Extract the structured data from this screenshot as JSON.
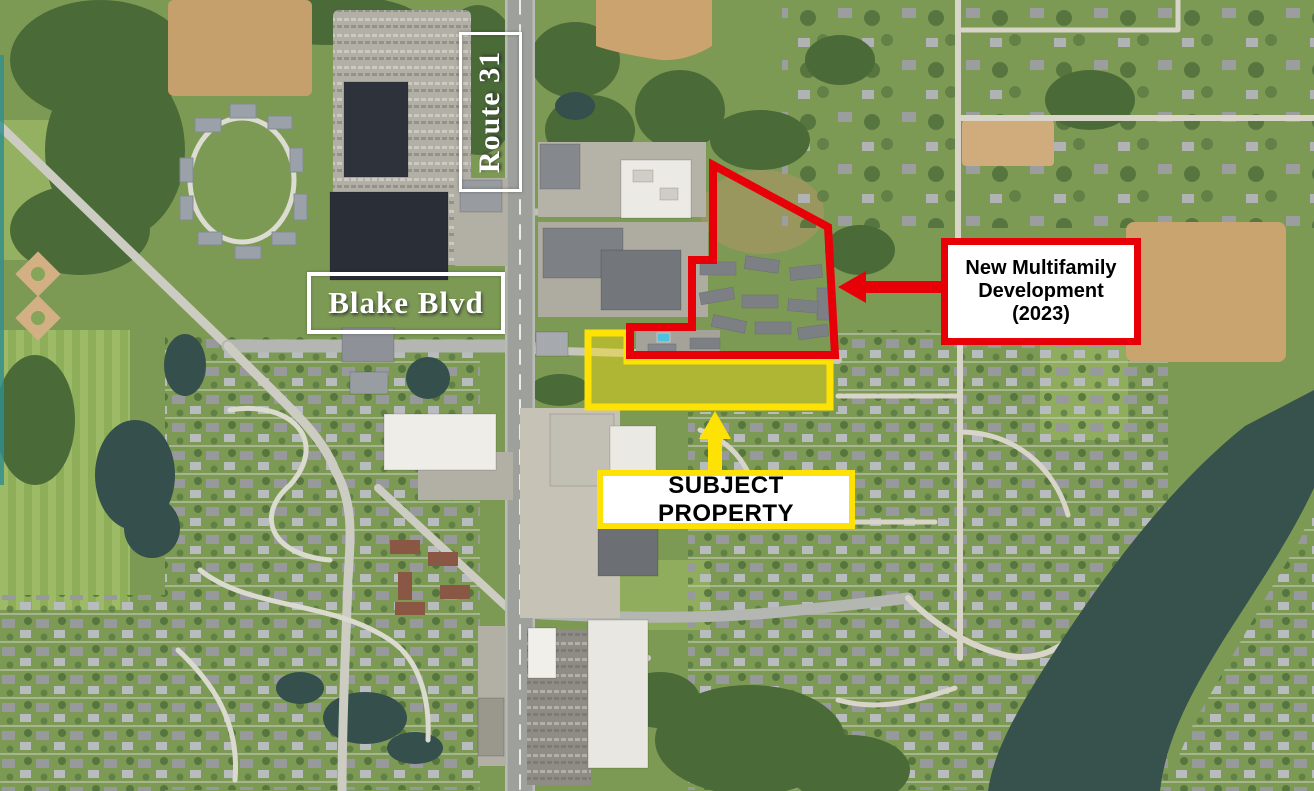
{
  "map": {
    "kind": "aerial-satellite-site-map",
    "road_labels": {
      "route": "Route 31",
      "street": "Blake Blvd"
    },
    "callouts": {
      "development": {
        "text": "New Multifamily\nDevelopment\n(2023)",
        "outline_color": "#e70008"
      },
      "subject": {
        "text": "SUBJECT PROPERTY",
        "outline_color": "#ffe205"
      }
    },
    "colors": {
      "development_outline_red": "#e70008",
      "subject_property_yellow": "#ffe205",
      "road_label_white": "#ffffff",
      "callout_text_black": "#000000"
    }
  }
}
